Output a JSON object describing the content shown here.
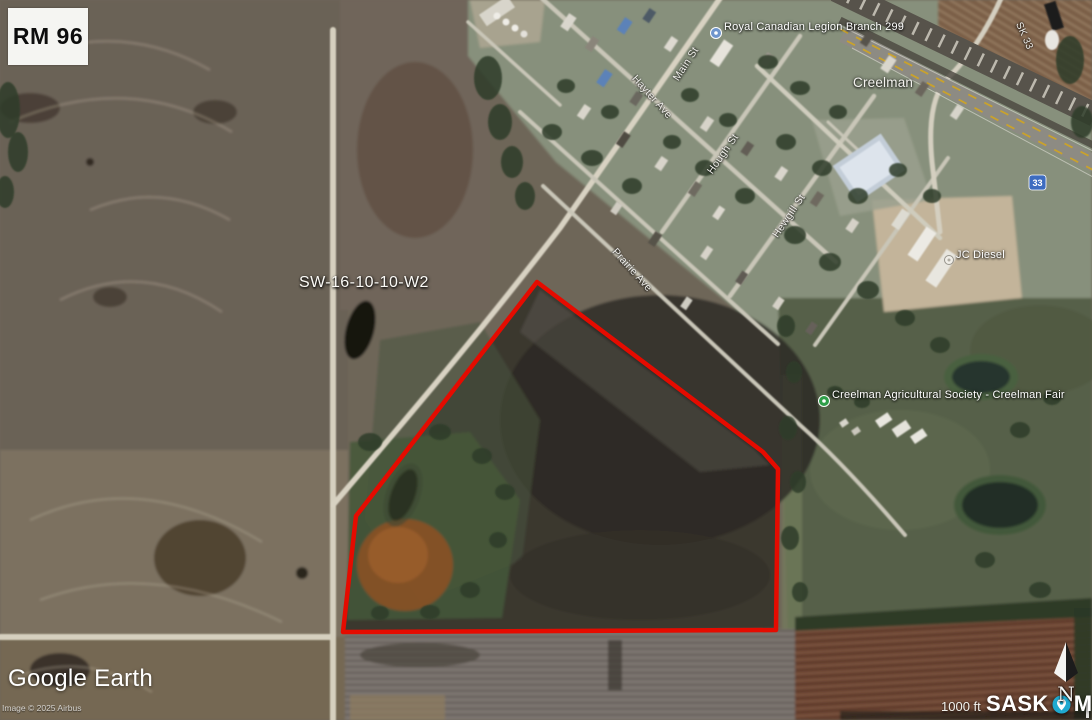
{
  "region_badge": {
    "label": "RM 96"
  },
  "parcel": {
    "legal_description": "SW-16-10-10-W2"
  },
  "places": {
    "legion": "Royal Canadian Legion Branch 299",
    "town": "Creelman",
    "fair": "Creelman Agricultural Society - Creelman Fair",
    "diesel": "JC Diesel"
  },
  "streets": {
    "main": "Main St",
    "hayter": "Hayter Ave",
    "hough": "Hough St",
    "hewgill": "Hewgill St",
    "prairie": "Prairie Ave",
    "highway": "SK 33",
    "highway_shield": "33"
  },
  "attribution": {
    "logo": "Google Earth",
    "imagery_credit": "Image © 2025 Airbus"
  },
  "scale_bar": {
    "label": "1000 ft"
  },
  "watermark": {
    "sask": "SASK",
    "mls": "MLS",
    "registered": "®"
  },
  "compass": {
    "label": "N"
  },
  "colors": {
    "parcel_outline": "#e50b00",
    "poi_blue": "#6f95cc",
    "poi_green": "#2f9e49",
    "mls_teal": "#1fa9d0",
    "shield_blue": "#3d6cc0"
  }
}
